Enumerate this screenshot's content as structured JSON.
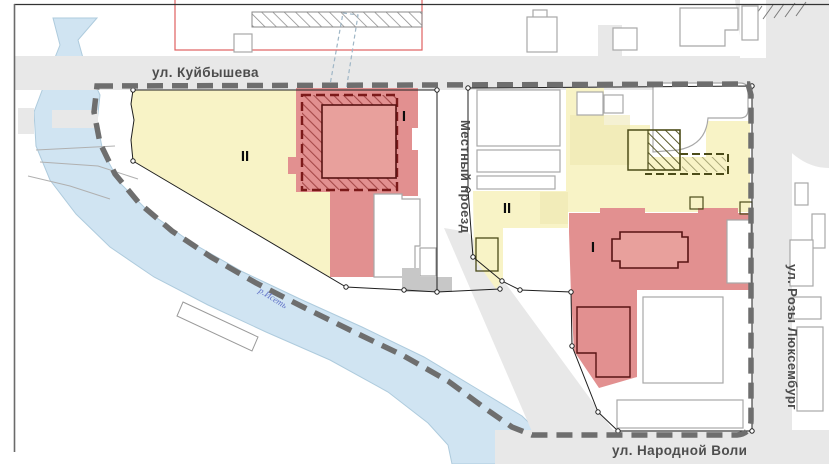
{
  "map": {
    "streets": {
      "kuybysheva": "ул. Куйбышева",
      "mestny_proezd": "Местный проезд",
      "narodnoy_voli": "ул. Народной Воли",
      "rozy_luxemburg": "ул. Розы Люксембург"
    },
    "river": {
      "label": "р.Исеть"
    },
    "zones": {
      "left_block": {
        "yellow_label": "II",
        "red_label": "I"
      },
      "right_block": {
        "yellow_label": "II",
        "red_label": "I"
      }
    },
    "colors": {
      "zone_yellow": "#f8f3c6",
      "zone_yellow_dark": "#ece5ae",
      "zone_red": "#e29090",
      "zone_red_building": "#e8a09c",
      "river": "#d0e4f2",
      "river_edge": "#aecbdd",
      "road": "#e8e8e8",
      "boundary_dash": "#6e6e6e",
      "cadastral": "#1f1f1f",
      "red_hatch_border": "#7c1a1a",
      "red_building_outline": "#581313",
      "olive_outline": "#4c4c19",
      "building_outline": "#a8a8a8",
      "gray_building": "#c7c7c7",
      "red_plan_outline": "#e06060"
    }
  }
}
